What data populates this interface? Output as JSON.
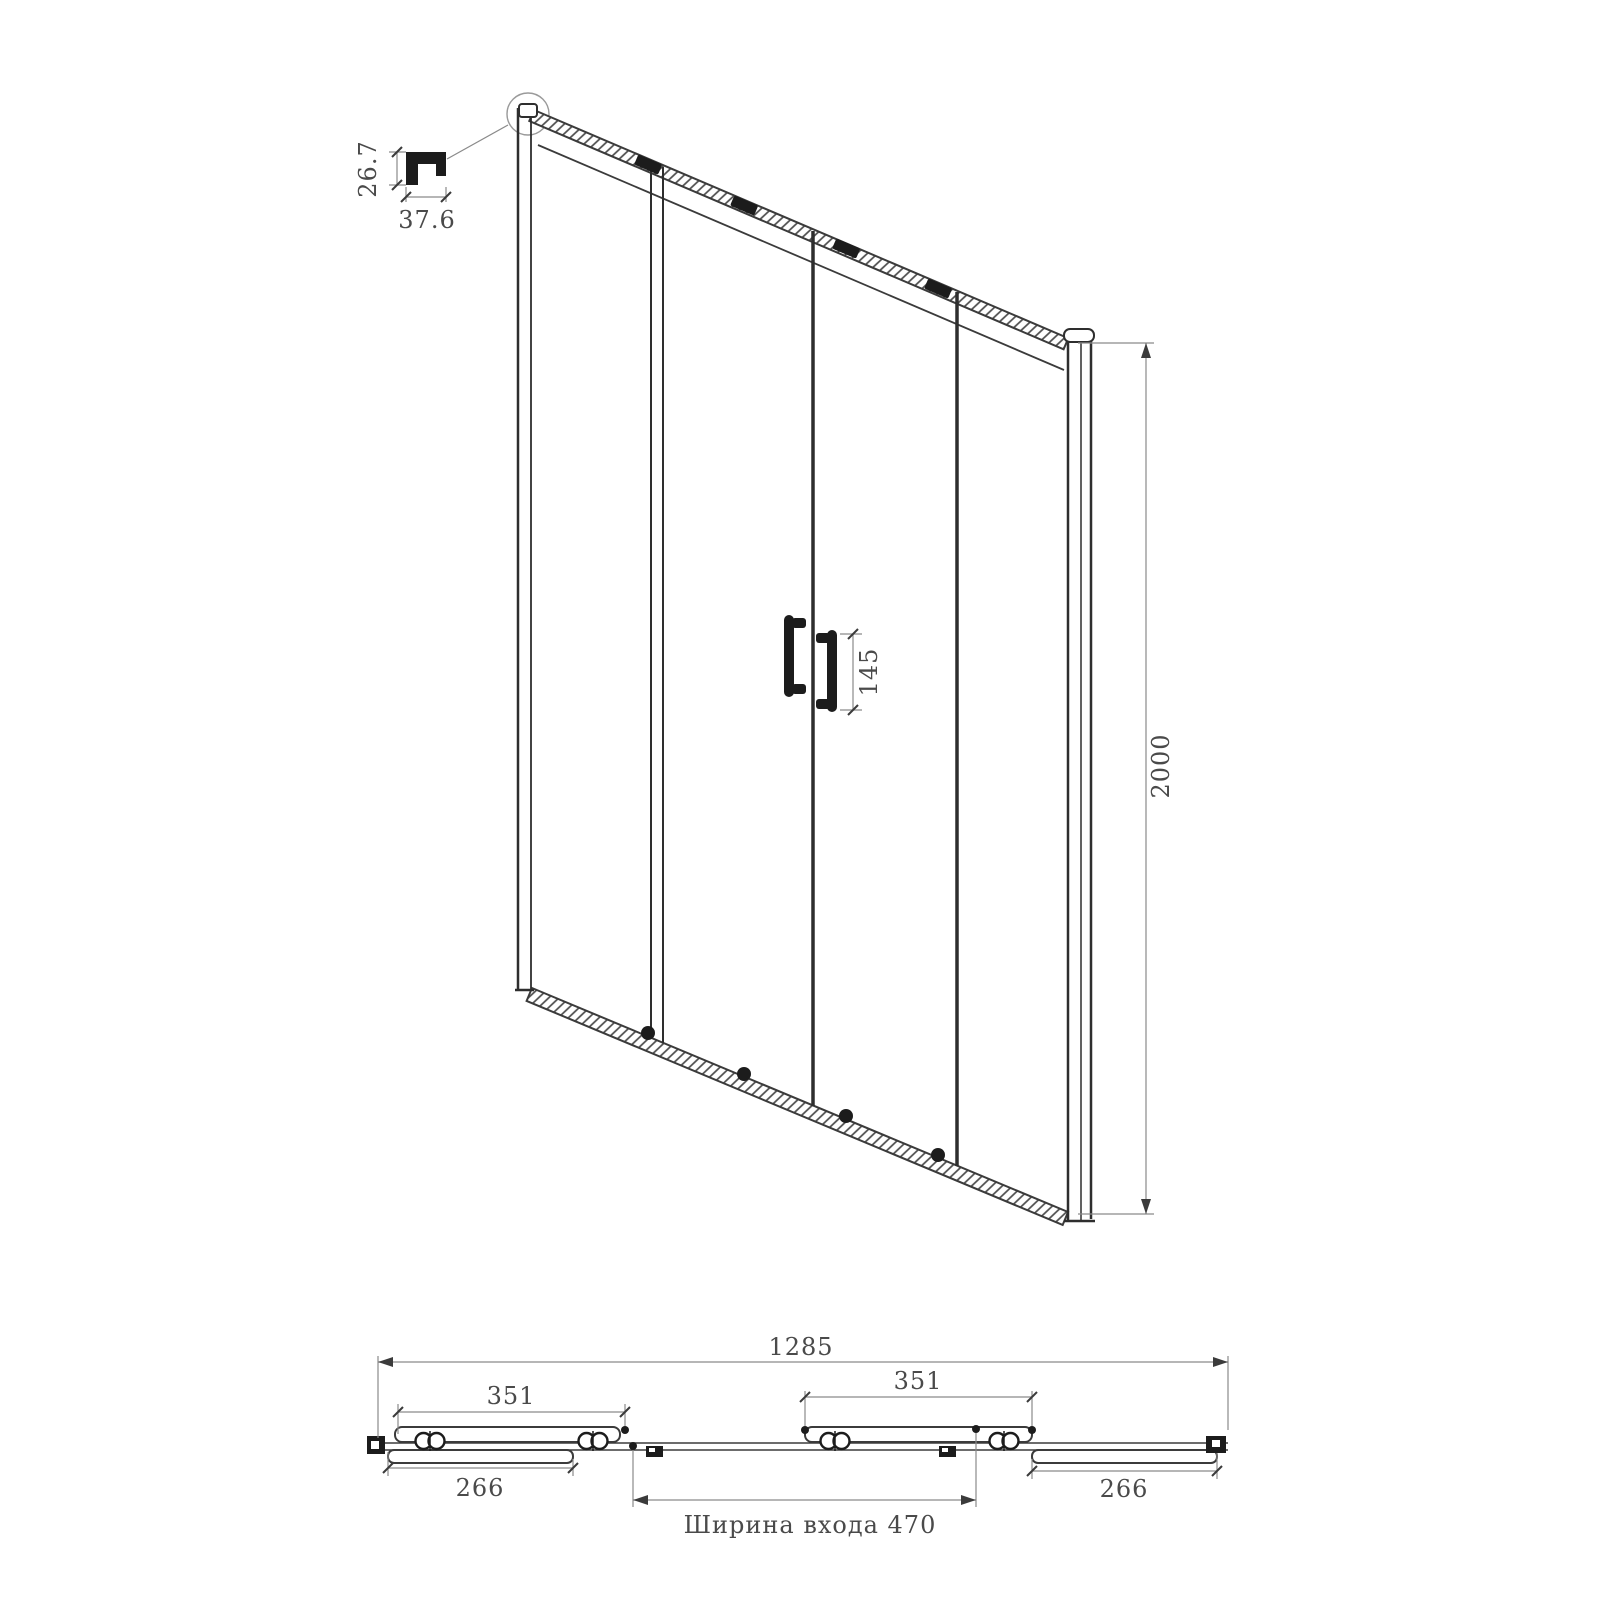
{
  "drawing": {
    "title": "sliding-shower-door-technical-drawing",
    "views": [
      "profile-detail",
      "front-perspective-view",
      "plan-view"
    ]
  },
  "detail": {
    "profile_height": "26.7",
    "profile_width": "37.6"
  },
  "front": {
    "handle_length": "145",
    "door_height": "2000"
  },
  "plan": {
    "overall_width": "1285",
    "slider_width_left": "351",
    "slider_width_right": "351",
    "fixed_panel_left": "266",
    "fixed_panel_right": "266",
    "entrance_width_label": "Ширина входа 470"
  },
  "colors": {
    "object_line": "#3b3b3b",
    "dim_line": "#8a8a8a",
    "text": "#4a4a4a",
    "hardware_fill": "#1c1c1c",
    "background": "#ffffff"
  }
}
